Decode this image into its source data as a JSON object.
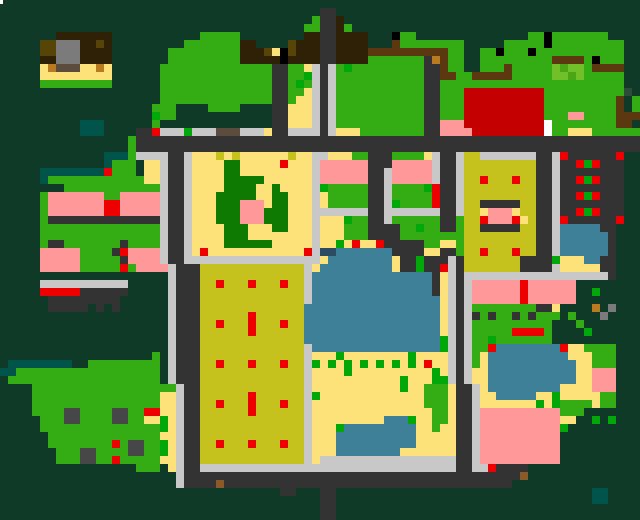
{
  "map": {
    "kind": "pixel-town-map",
    "width_px": 640,
    "height_px": 520,
    "cell_px": 8,
    "cols": 80,
    "rows": 65,
    "palette": {
      ".": "#0e3a27",
      "g": "#33ad13",
      "G": "#02a80a",
      "F": "#0e7a02",
      "e": "#72c029",
      "m": "#4aa616",
      "y": "#fce278",
      "Y": "#c6c21d",
      "r": "#ee0000",
      "R": "#c50000",
      "p": "#ff9898",
      "w": "#3f8099",
      "z": "#2d4c64",
      "d": "#333333",
      "D": "#474747",
      "l": "#c8c8c8",
      "k": "#2e2105",
      "K": "#5b3810",
      "o": "#564506",
      "O": "#ba7a20",
      "n": "#8a5a28",
      "s": "#7b7b7b",
      "t": "#5b4c3d",
      "T": "#00544a",
      "b": "#000000",
      "S": "#2e4a38",
      "x": "#ffffff"
    },
    "legend": {
      "background_forest": ".",
      "grass_tree": "g",
      "bush_dot": "G",
      "park_hedge": "F",
      "light_grass": "e",
      "sand_plaza": "y",
      "olive_yard": "Y",
      "red_marker": "r",
      "crimson_building": "R",
      "pink_building": "p",
      "water": "w",
      "road": "d",
      "building_gray": "D",
      "sidewalk": "l",
      "roof_dark_brown": "k",
      "fence_brown": "K",
      "teal_path": "T"
    },
    "grid": [
      "................................................................................",
      "........................................dd......................................",
      ".......................................gddk.....................................",
      "......................................ggddkg....................................",
      ".......kkkkkkk............ggggg........kkddkkkk...bgg..............ggbggggggg....",
      ".....oosسsskkok.............ggggggggkk....okkkddkkkk...Kgggggggg.....gggggbggggggggg..",
      ".....oosسsskkkk.......gggggggggkkkoybokkkddkkkkKKKKKKKKKKgg..ggbgggbggggggggggg..",
      ".....kksسsskkkk.......gggggggggkkkkkbkkkkddkkkkgggggggdOKgg..gggggggggKKKKgbggg..",
      ".....yOtttyyOy......ggggggggggggggddggyldlgGgggggggggddKgg..gggKgggggemeegKKKK..",
      ".....yyyyyyyyy......ggggggggggggggddggGldlggggggggggggddKKggKKKKKgggggeemeggggg..",
      ".....ggggggggg......ggggggggggggggddgGgldlggggggggggggddggggggggggggggggggggg..",
      "....................ggggggggggggggddggyldlggggggggggggddgggRRRRRRRRRRgggggggggS.",
      "....................ggggggggggggggddgyyldlggggggggggggddgggRRRRRRRRRRgggggggK.g",
      ".........ggg....gggg....ddyyyldlggggggggggggddgggRRRRRRRRRRgggggggK.g...........",
      ".........Ggg........"
    ],
    "overlays": [
      {
        "name": "white-pixel-artifact",
        "x": 0,
        "y": 0,
        "w": 3,
        "h": 4,
        "color": "#ffffff"
      }
    ]
  }
}
